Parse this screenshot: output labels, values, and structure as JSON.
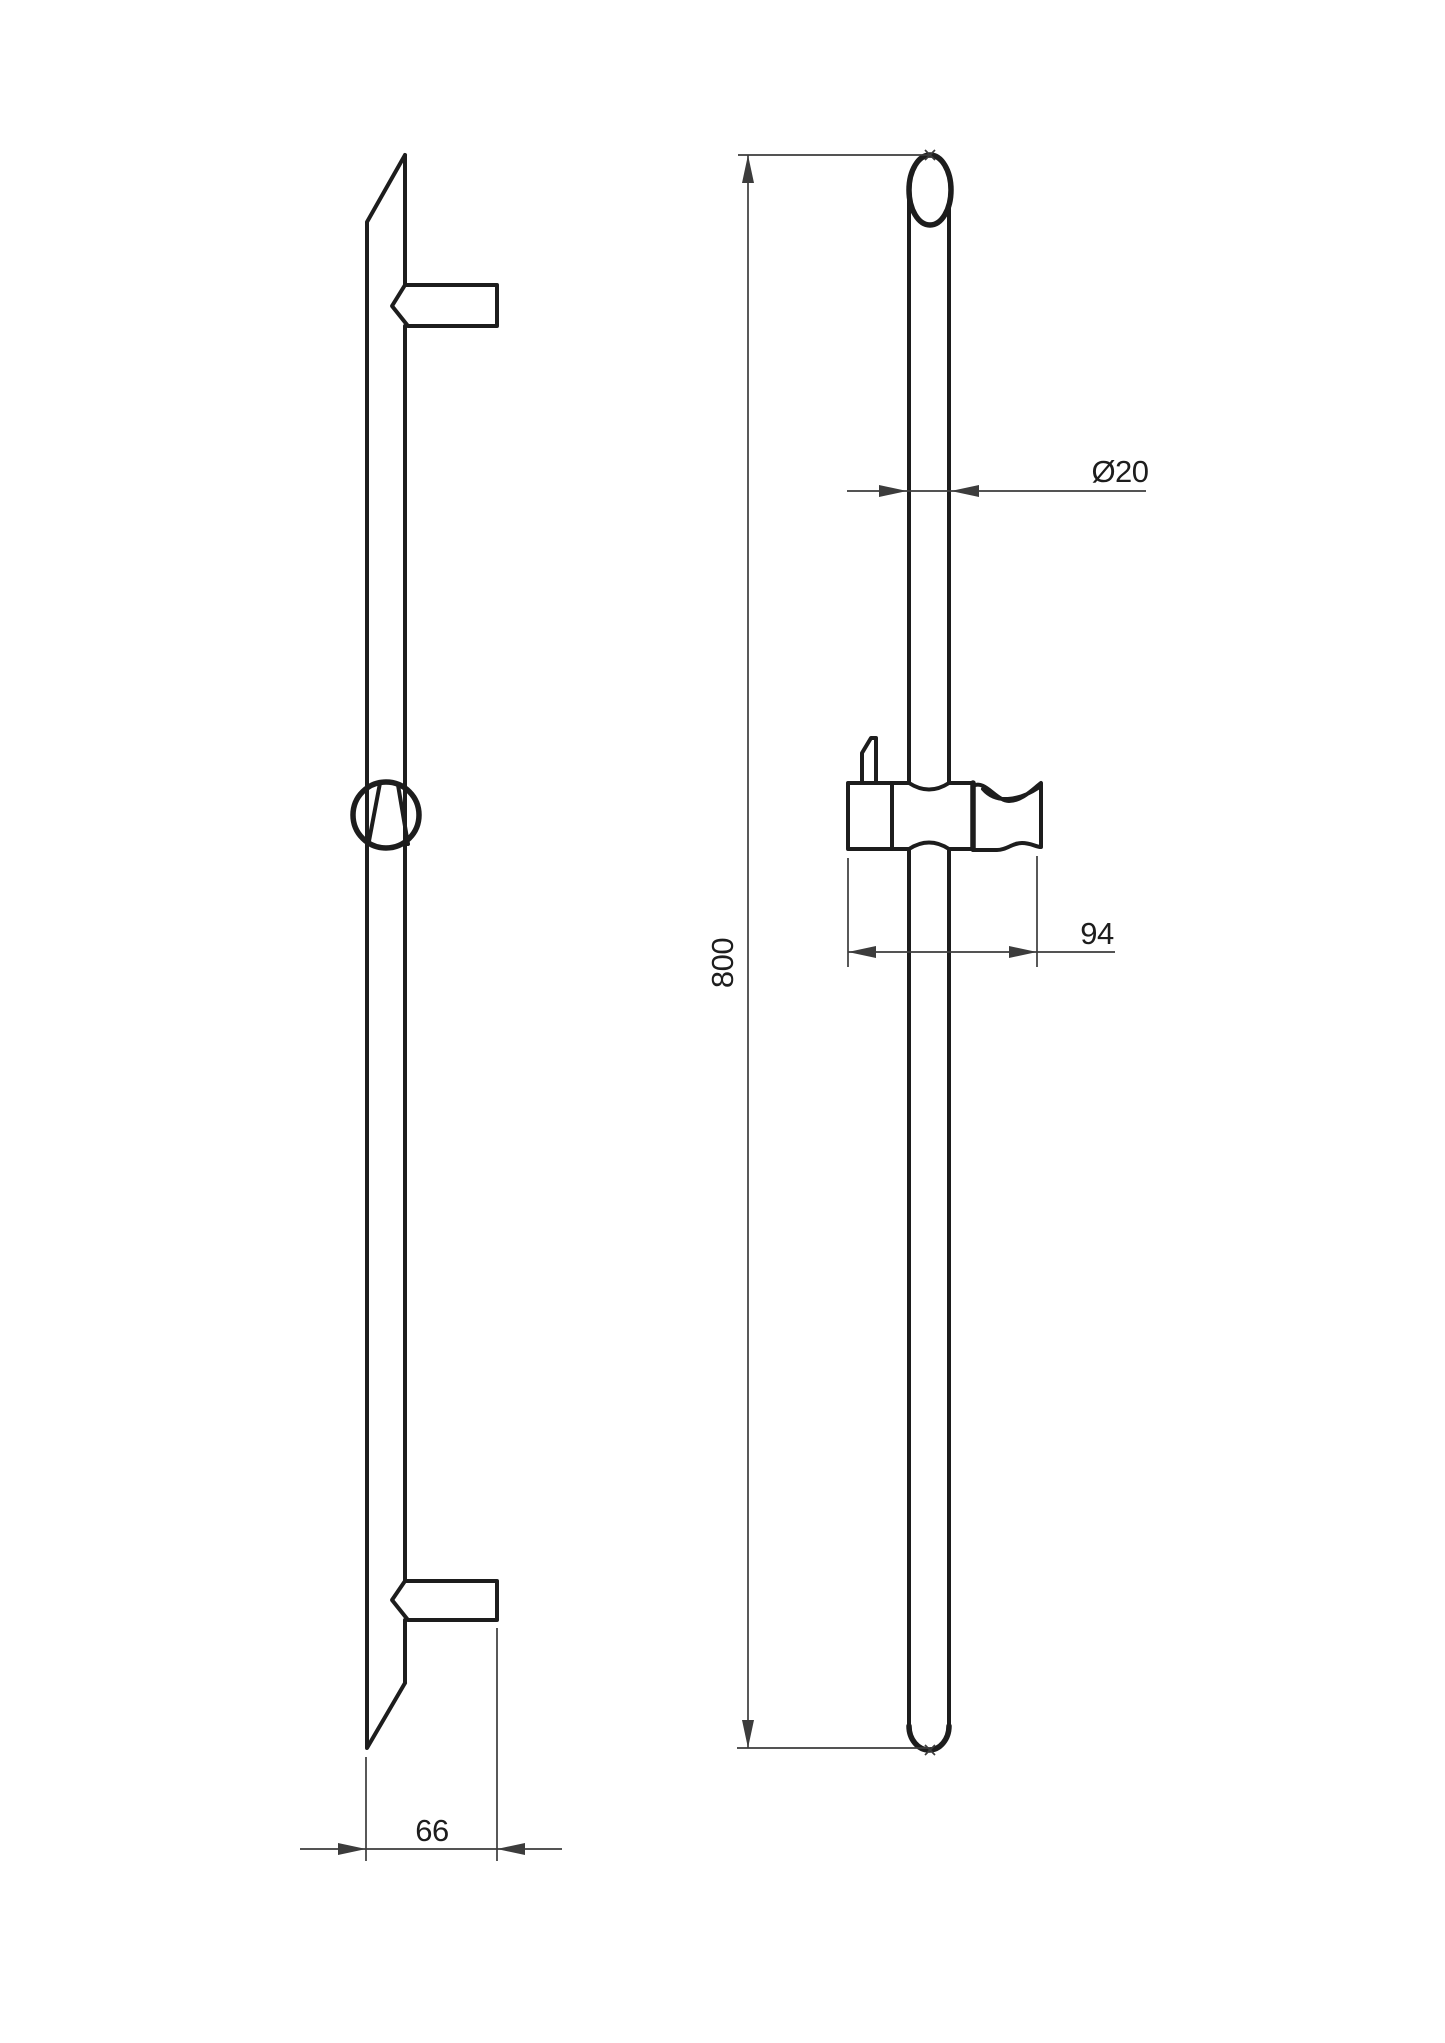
{
  "theme": {
    "background": "#ffffff",
    "line_color": "#1d1d1d",
    "dim_color": "#3c3c3c",
    "text_color": "#1d1d1d"
  },
  "drawing": {
    "type": "technical-drawing",
    "dimensions": {
      "rail_length": {
        "label": "800"
      },
      "tube_diameter": {
        "label": "Ø20"
      },
      "holder_width": {
        "label": "94"
      },
      "bracket_depth": {
        "label": "66"
      }
    }
  }
}
